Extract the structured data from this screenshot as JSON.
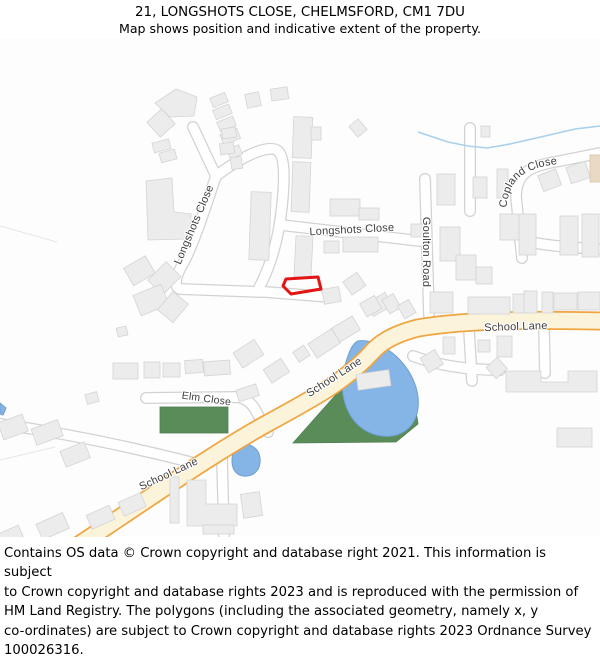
{
  "header": {
    "title": "21, LONGSHOTS CLOSE, CHELMSFORD, CM1 7DU",
    "subtitle": "Map shows position and indicative extent of the property."
  },
  "map": {
    "street_labels": {
      "longshots_west": "Longshots Close",
      "longshots_east": "Longshots Close",
      "goulton_road": "Goulton Road",
      "copland_close": "Copland Close",
      "school_lane_east": "School Lane",
      "school_lane_mid": "School Lane",
      "school_lane_west": "School Lane",
      "elm_close": "Elm Close"
    },
    "colors": {
      "plot_outline": "#e41414",
      "primary_road_edge": "#efa540",
      "primary_road_fill": "#fcf4da",
      "minor_road_fill": "#ffffff",
      "green_space": "#5a8c5a",
      "water": "#84b5e6",
      "building_fill": "#ececec"
    }
  },
  "footer": {
    "lines": [
      "Contains OS data © Crown copyright and database right 2021. This information is subject",
      "to Crown copyright and database rights 2023 and is reproduced with the permission of",
      "HM Land Registry. The polygons (including the associated geometry, namely x, y",
      "co-ordinates) are subject to Crown copyright and database rights 2023 Ordnance Survey",
      "100026316."
    ]
  }
}
